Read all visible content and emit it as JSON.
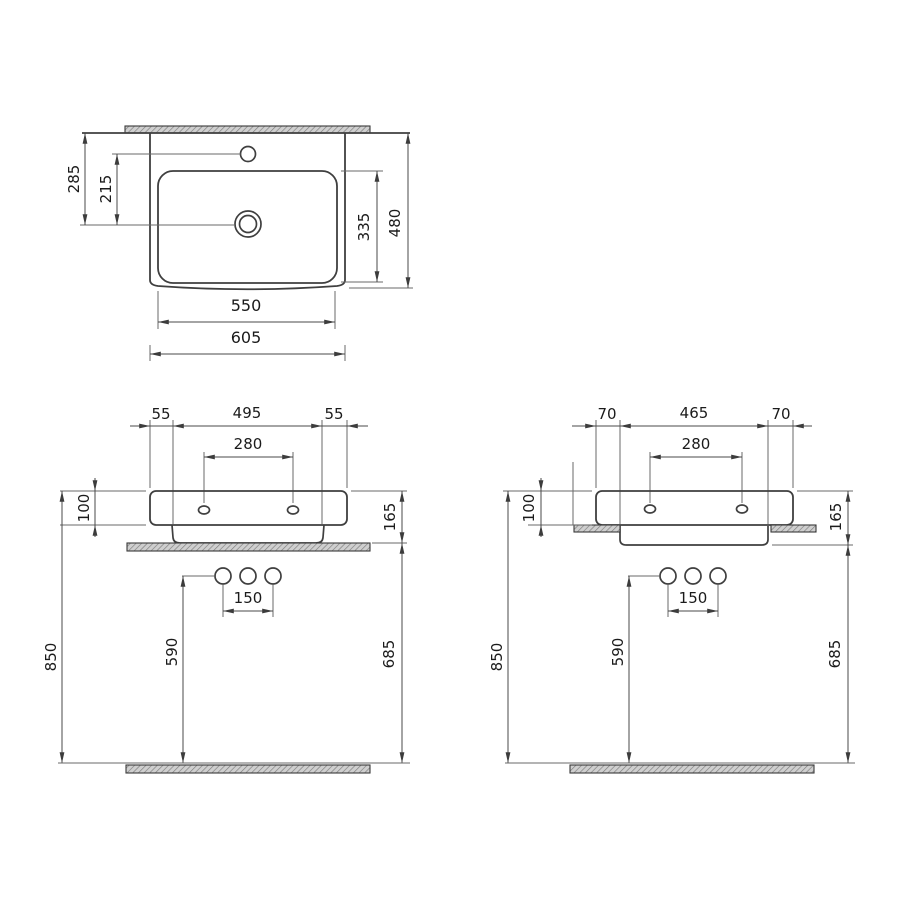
{
  "drawing": {
    "product": "rectangular washbasin dimension drawing",
    "units": "mm",
    "colors": {
      "line": "#3f3f3f",
      "dimension_line": "#4a4a4a",
      "text": "#1b1b1b",
      "hatch_fill": "#cfcfcf",
      "hatch_stroke": "#7d7d7d",
      "background": "#ffffff"
    },
    "views": {
      "top": {
        "dims": {
          "wall_to_drain": "285",
          "tap_to_drain": "215",
          "bowl_depth": "335",
          "overall_depth": "480",
          "bowl_width": "550",
          "overall_width": "605"
        }
      },
      "front_countertop": {
        "dims": {
          "left_edge": "55",
          "base_width": "495",
          "right_edge": "55",
          "tap_hole_spacing": "280",
          "rim_height": "100",
          "basin_total_height": "165",
          "waste_hole_spacing": "150",
          "waste_holes_height": "590",
          "rim_to_floor": "850",
          "underside_to_floor": "685"
        }
      },
      "front_semi_recessed": {
        "dims": {
          "left_edge": "70",
          "base_width": "465",
          "right_edge": "70",
          "tap_hole_spacing": "280",
          "rim_height": "100",
          "basin_total_height": "165",
          "waste_hole_spacing": "150",
          "waste_holes_height": "590",
          "rim_to_floor": "850",
          "underside_to_floor": "685"
        }
      }
    }
  }
}
